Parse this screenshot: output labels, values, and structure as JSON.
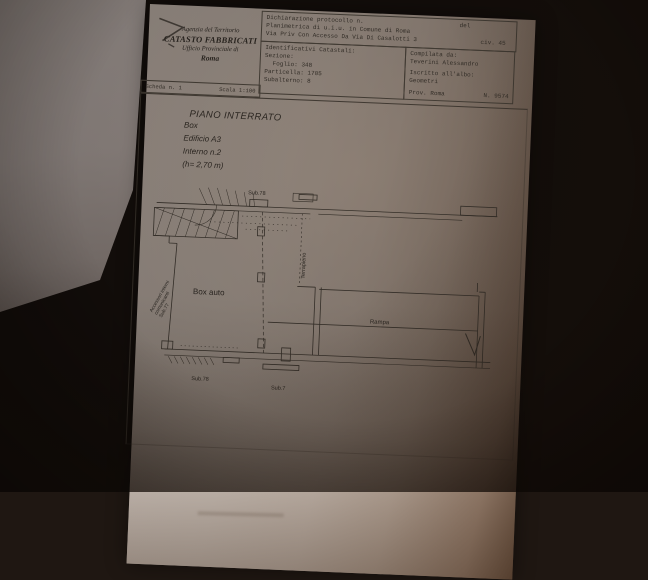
{
  "photo": {
    "background_color": "#1f1712",
    "paper_color": "#ece6e0",
    "line_color": "#5b564e",
    "shadow_color": "#6f5847"
  },
  "header": {
    "agency": {
      "line1": "Agenzia del Territorio",
      "line2": "CATASTO FABBRICATI",
      "line3": "Ufficio Provinciale di",
      "line4": "Roma"
    },
    "declaration": {
      "protocol_label": "Dichiarazione protocollo n.",
      "protocol_del": "del",
      "planimetria": "Planimetrica di u.i.u. in Comune di Roma",
      "address": "Via Priv Con Accesso Da Via Di Casalotti 3",
      "civ": "civ. 45"
    },
    "catastal": {
      "title": "Identificativi Catastali:",
      "sezione": "Sezione:",
      "foglio": "Foglio: 348",
      "particella": "Particella: 1705",
      "subalterno": "Subalterno: 8"
    },
    "compiler": {
      "compilata_label": "Compilata da:",
      "name": "Teverini Alessandro",
      "albo_label": "Iscritto all'albo:",
      "albo": "Geometri",
      "prov": "Prov. Roma",
      "number": "N. 9574"
    },
    "sheet": {
      "scheda": "Scheda n. 1",
      "scala": "Scala 1:100"
    }
  },
  "plan": {
    "title_block": [
      "PIANO INTERRATO",
      "Box",
      "Edificio A3",
      "Interno n.2",
      "(h= 2,70 m)"
    ],
    "labels": {
      "sub78_top": "Sub.78",
      "terrapieno": "Terrapieno",
      "accessori_lines": [
        "Accessori interni",
        "comunicanti",
        "Sub.77"
      ],
      "box_auto": "Box auto",
      "rampa": "Rampa",
      "sub78_bottom": "Sub.78",
      "sub7_bottom": "Sub.7"
    }
  }
}
